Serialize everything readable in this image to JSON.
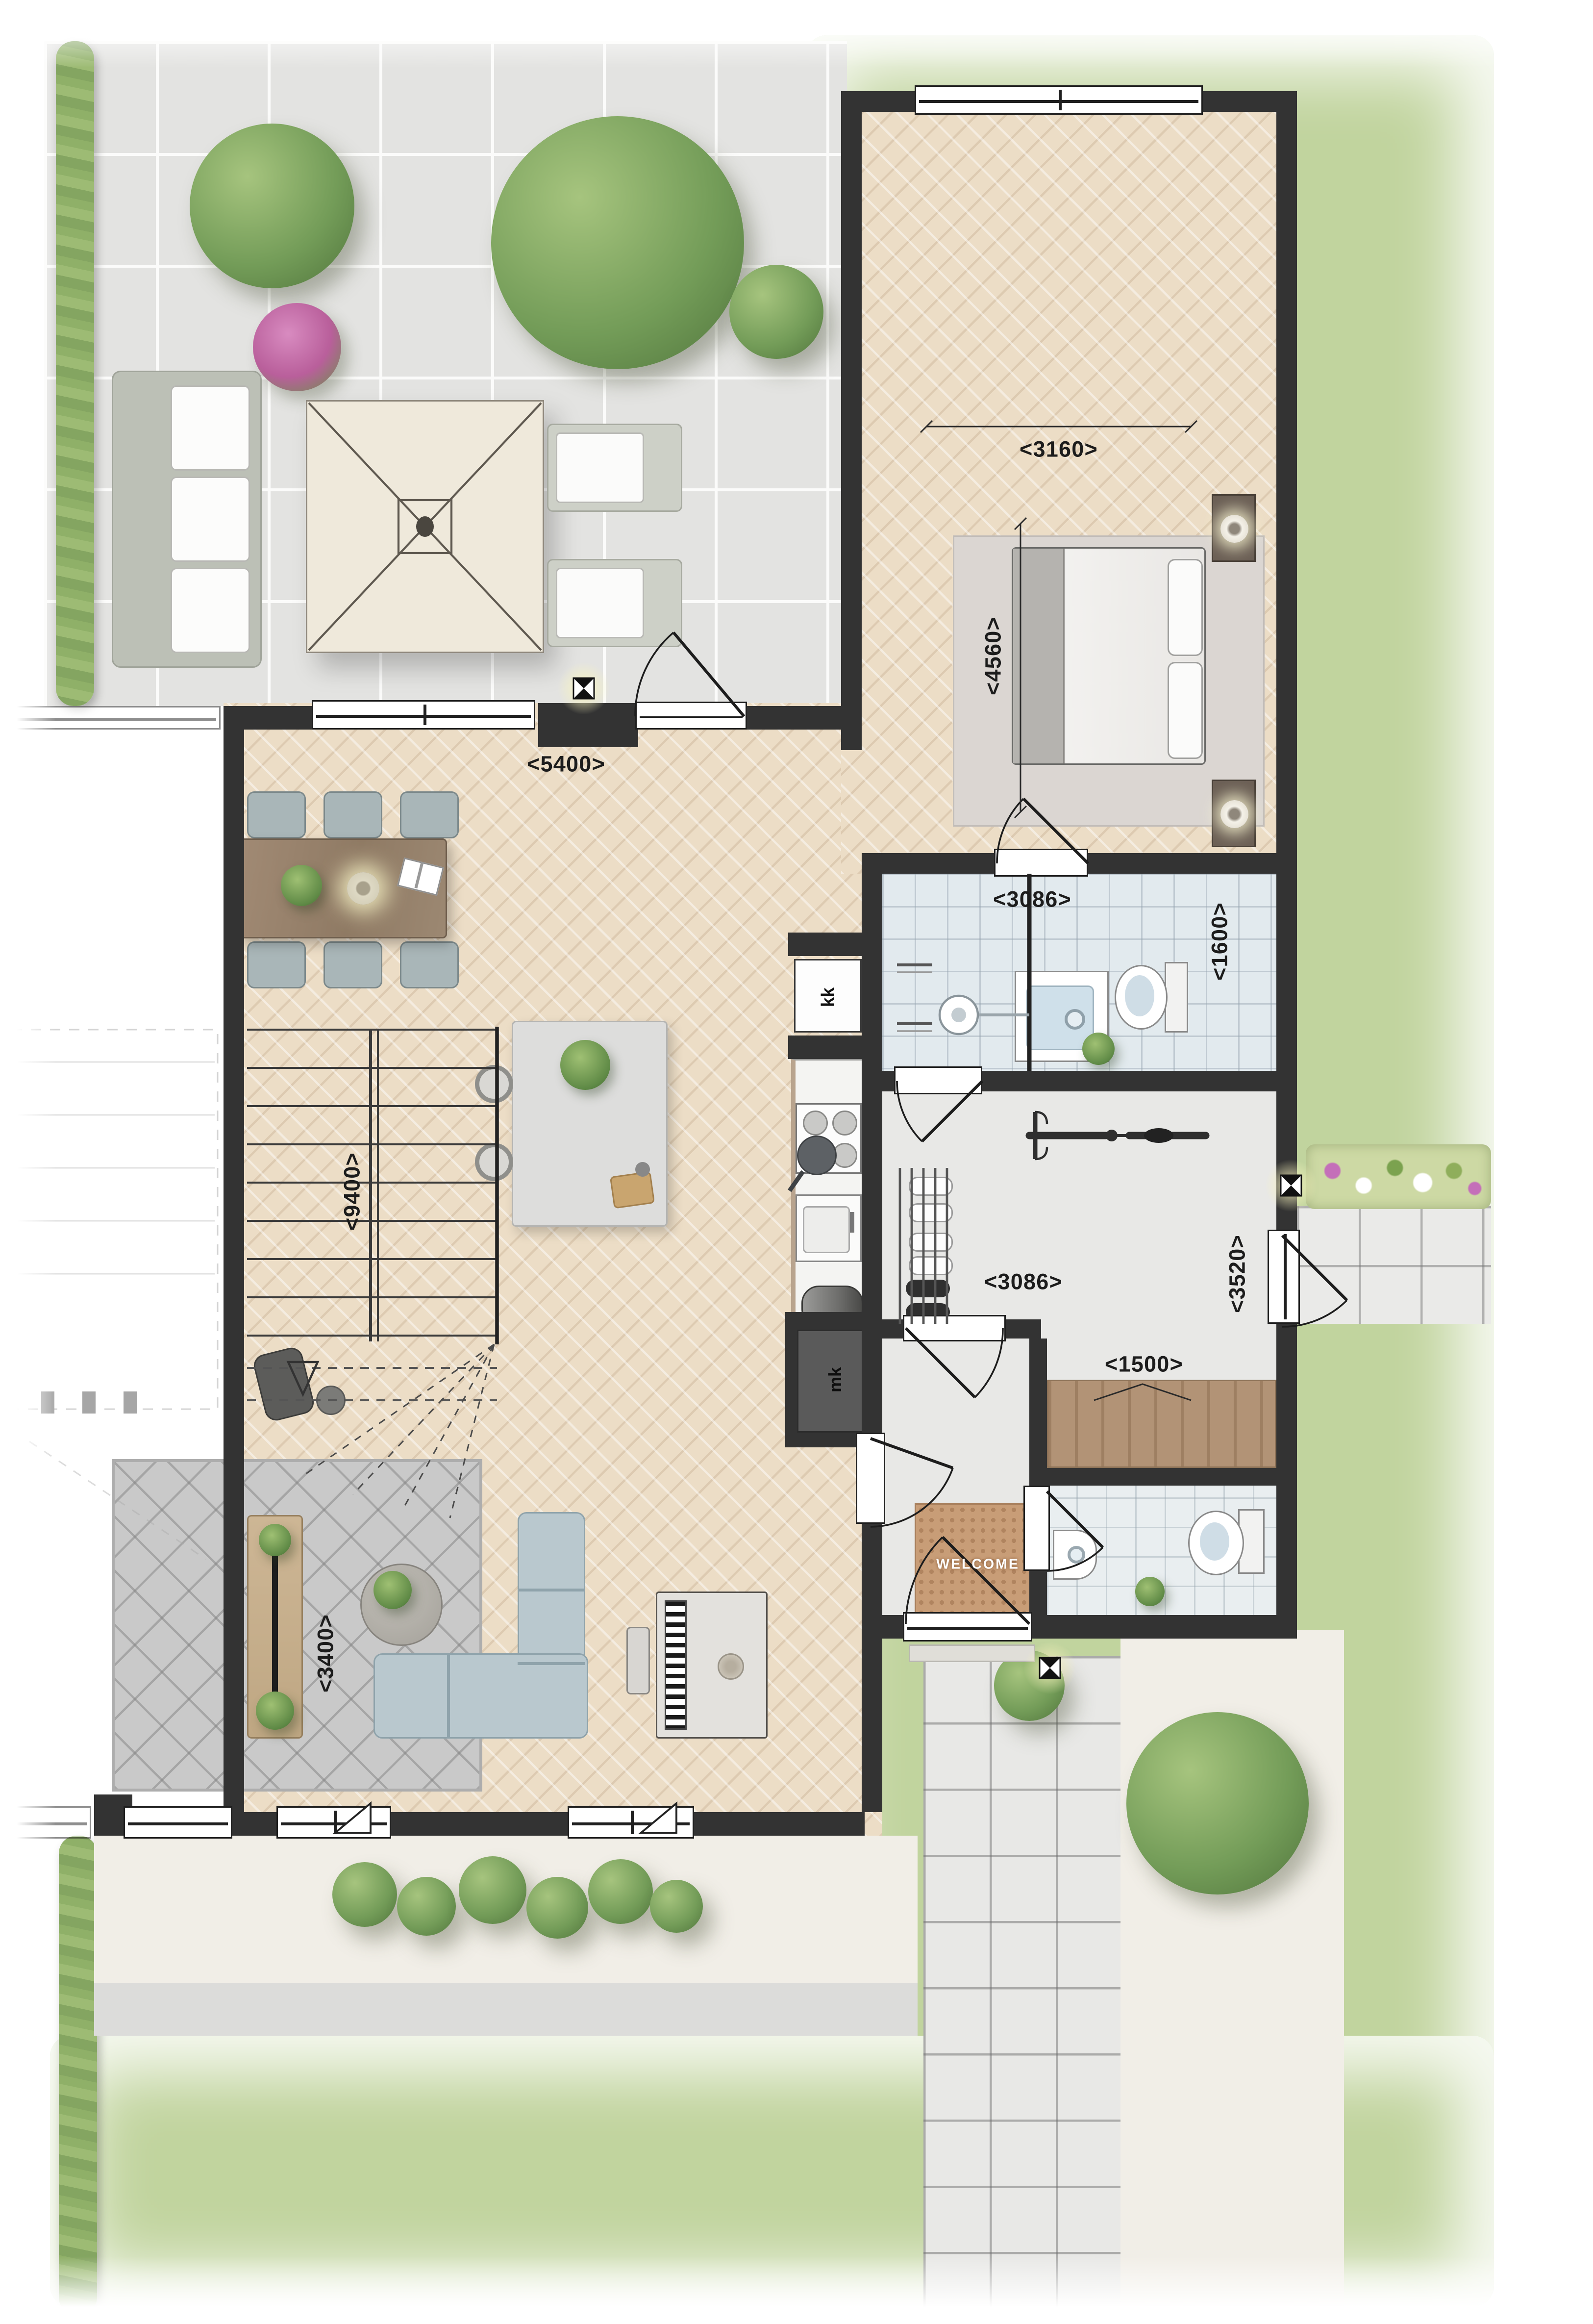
{
  "plan": {
    "dimensions": {
      "bedroom_width": "<3160>",
      "bedroom_depth": "<4560>",
      "living_width": "<5400>",
      "bathroom_width": "<3086>",
      "bathroom_depth": "<1600>",
      "living_depth": "<9400>",
      "hall_width": "<3086>",
      "hall_depth": "<3520>",
      "entrance_width": "<1500>",
      "lounge_depth": "<3400>"
    },
    "labels": {
      "fridge": "kk",
      "meter_cupboard": "mk",
      "doormat": "WELCOME"
    },
    "colors": {
      "wall": "#333333",
      "wood_floor": "#ecddc6",
      "bathroom_tile": "#e2eaee",
      "lawn": "#c1d49e",
      "patio_tile": "#e3e3e1",
      "sofa": "#b9c8ce",
      "doormat": "#c89d77",
      "dimension_text": "#1c1c1c"
    }
  }
}
